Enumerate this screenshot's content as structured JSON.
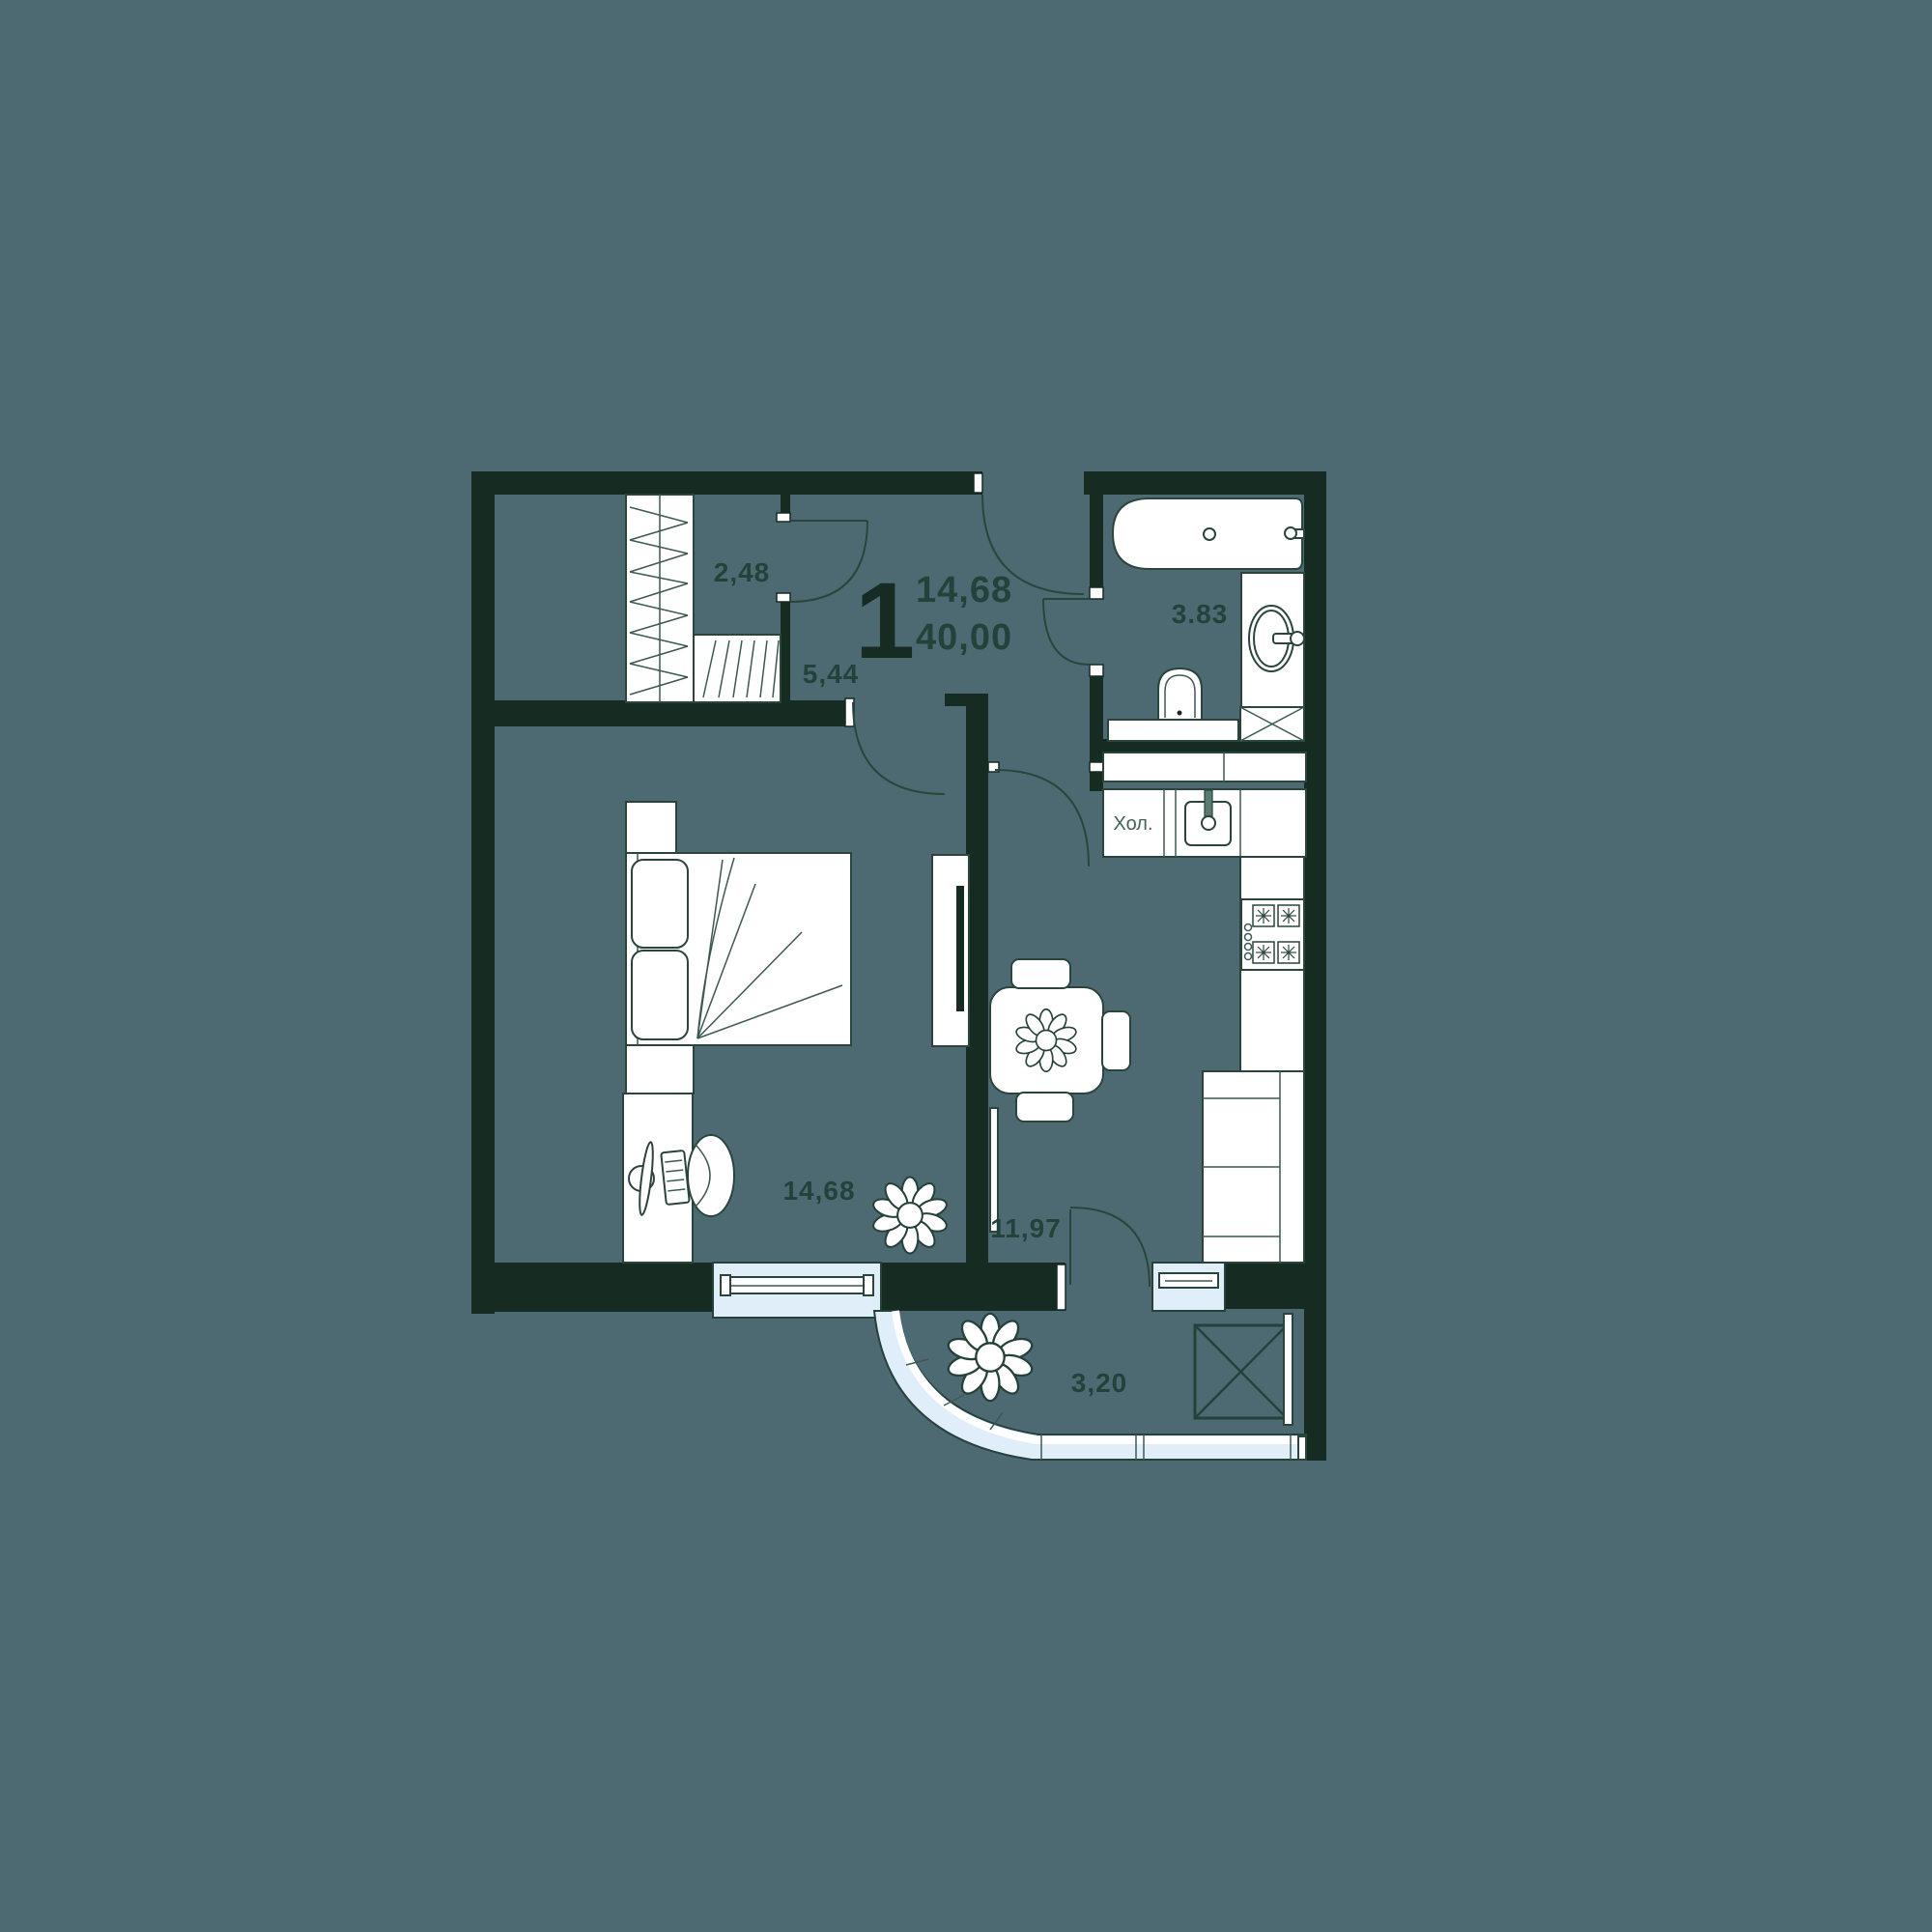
{
  "floor_plan": {
    "summary": {
      "rooms_count": "1",
      "living_area": "14,68",
      "total_area": "40,00"
    },
    "rooms": [
      {
        "name": "wardrobe",
        "area": "2,48"
      },
      {
        "name": "hallway",
        "area": "5,44"
      },
      {
        "name": "bathroom",
        "area": "3.83"
      },
      {
        "name": "bedroom",
        "area": "14,68"
      },
      {
        "name": "kitchen-living-room",
        "area": "11,97"
      },
      {
        "name": "balcony",
        "area": "3,20"
      }
    ],
    "appliance_labels": {
      "fridge": "Хол."
    },
    "colors": {
      "background": "#4d6a72",
      "walls": "#162b22",
      "furniture": "#ffffff",
      "outline": "#2a453b",
      "glazing": "#dfeef8",
      "text": "#23423a"
    }
  }
}
